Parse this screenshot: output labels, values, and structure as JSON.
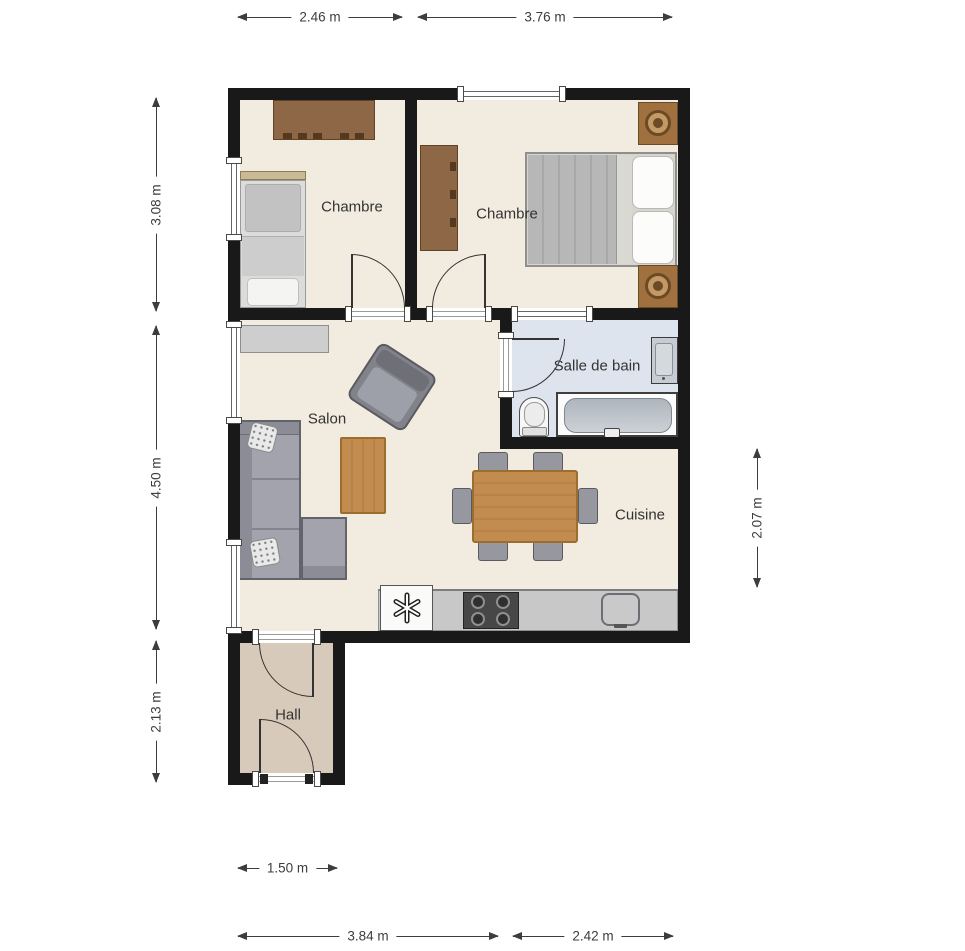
{
  "plan": {
    "title": "Apartment floor plan",
    "rooms": [
      {
        "id": "chambre1",
        "label": "Chambre"
      },
      {
        "id": "chambre2",
        "label": "Chambre"
      },
      {
        "id": "salle_de_bain",
        "label": "Salle de bain"
      },
      {
        "id": "salon",
        "label": "Salon"
      },
      {
        "id": "cuisine",
        "label": "Cuisine"
      },
      {
        "id": "hall",
        "label": "Hall"
      }
    ],
    "dimensions": {
      "top": [
        "2.46 m",
        "3.76 m"
      ],
      "left": [
        "3.08 m",
        "4.50 m",
        "2.13 m"
      ],
      "right": [
        "2.07 m"
      ],
      "bottom_hall": "1.50 m",
      "bottom": [
        "3.84 m",
        "2.42 m"
      ]
    },
    "icons": {
      "fridge_freezer_icon": "✳"
    },
    "colors": {
      "wall": "#191919",
      "floor_main": "#f1ecdf",
      "floor_hall": "#d8cabb",
      "floor_bath": "#dde4ee",
      "wood_furniture": "#c28c4e",
      "brown_furniture": "#8e6747",
      "sofa_gray": "#9b9ca6",
      "dimension_text": "#3d3d3d"
    }
  }
}
